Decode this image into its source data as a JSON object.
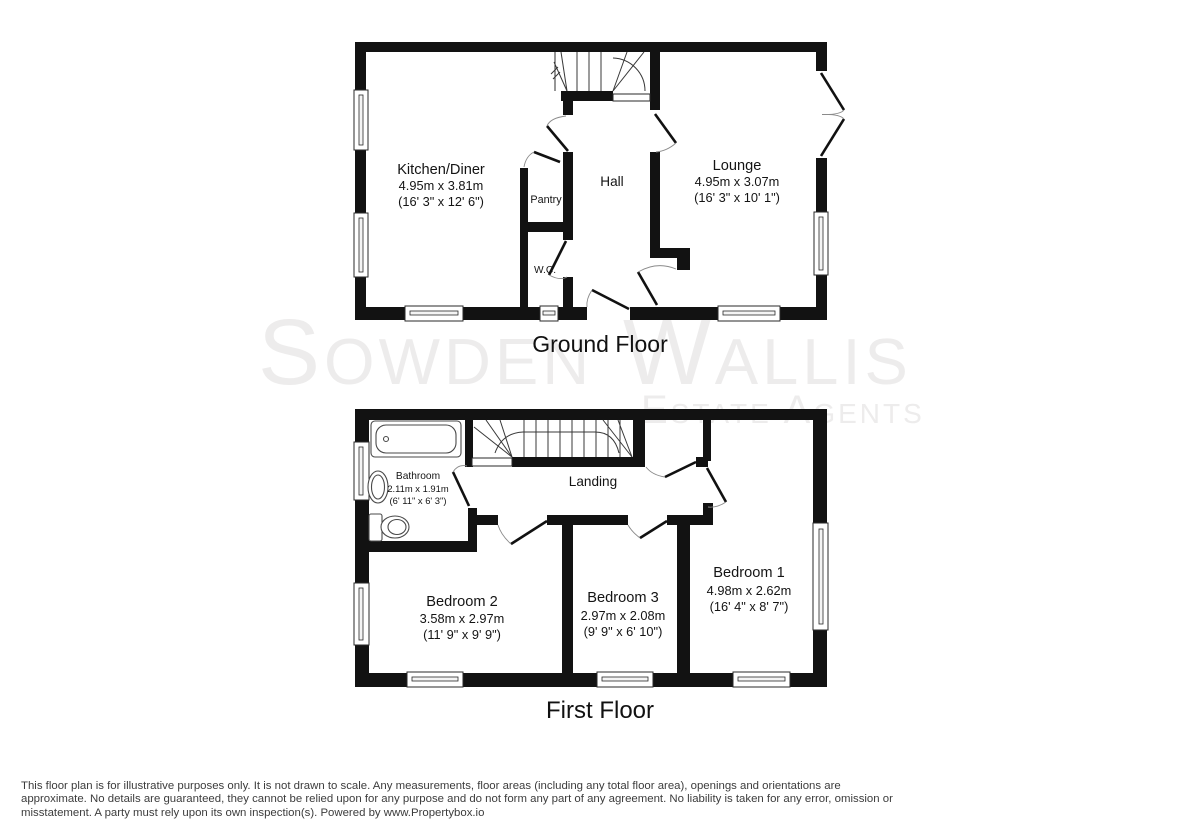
{
  "colors": {
    "background": "#ffffff",
    "wall": "#121212",
    "watermark": "#edecec",
    "label_text": "#141414",
    "disclaimer_text": "#3c3c3c"
  },
  "watermark": {
    "brand": "Sowden Wallis",
    "tagline": "Estate Agents"
  },
  "ground_floor": {
    "title": "Ground Floor",
    "rooms": {
      "kitchen": {
        "name": "Kitchen/Diner",
        "metric": "4.95m x 3.81m",
        "imperial": "(16' 3\" x 12' 6\")"
      },
      "pantry": {
        "name": "Pantry"
      },
      "hall": {
        "name": "Hall"
      },
      "wc": {
        "name": "W.C."
      },
      "lounge": {
        "name": "Lounge",
        "metric": "4.95m x 3.07m",
        "imperial": "(16' 3\" x 10' 1\")"
      }
    }
  },
  "first_floor": {
    "title": "First Floor",
    "rooms": {
      "bathroom": {
        "name": "Bathroom",
        "metric": "2.11m x 1.91m",
        "imperial": "(6' 11\" x 6' 3\")"
      },
      "landing": {
        "name": "Landing"
      },
      "bedroom2": {
        "name": "Bedroom 2",
        "metric": "3.58m x 2.97m",
        "imperial": "(11' 9\" x 9' 9\")"
      },
      "bedroom3": {
        "name": "Bedroom 3",
        "metric": "2.97m x 2.08m",
        "imperial": "(9' 9\" x 6' 10\")"
      },
      "bedroom1": {
        "name": "Bedroom 1",
        "metric": "4.98m x 2.62m",
        "imperial": "(16' 4\" x 8' 7\")"
      }
    }
  },
  "disclaimer": {
    "line1": "This floor plan is for illustrative purposes only. It is not drawn to scale. Any measurements, floor areas (including any total floor area), openings and orientations are",
    "line2": "approximate. No details are guaranteed, they cannot be relied upon for any purpose and do not form any part of any agreement. No liability is taken for any error, omission or",
    "line3": "misstatement. A party must rely upon its own inspection(s). Powered by www.Propertybox.io"
  }
}
